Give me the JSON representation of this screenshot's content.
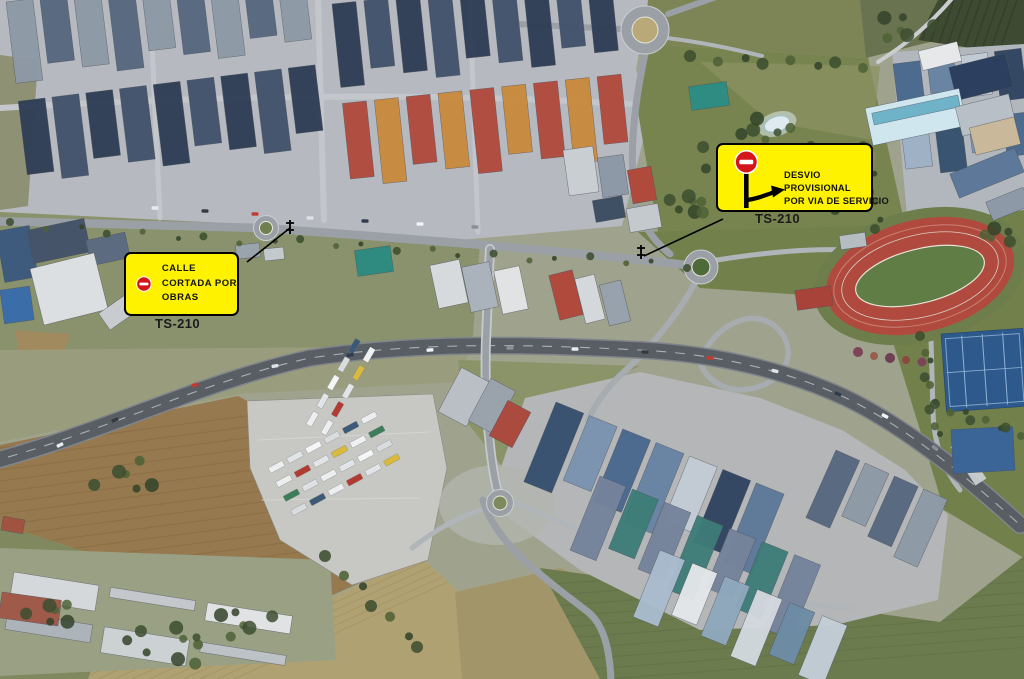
{
  "image": {
    "kind": "aerial-satellite-photo",
    "subject": "Industrial estate crossed by road TS-210 with roundabouts, highway, truck parking, athletics track and tennis courts"
  },
  "road_labels": [
    {
      "id": "ts210-west",
      "text": "TS-210"
    },
    {
      "id": "ts210-east",
      "text": "TS-210"
    }
  ],
  "annotations": {
    "colors": {
      "callout_background": "#FEF200",
      "callout_border": "#000000",
      "no_entry_red": "#D2161B",
      "no_entry_bar": "#FFFFFF",
      "leader_line": "#000000",
      "label_text": "#1B1B1B"
    },
    "closure_callout": {
      "icon": "no-entry-icon",
      "lines": [
        "CALLE",
        "CORTADA POR",
        "OBRAS"
      ]
    },
    "detour_callout": {
      "icon": "no-entry-signpost-icon",
      "arrow_icon": "detour-arrow-icon",
      "lines": [
        "DESVIO",
        "PROVISIONAL",
        "POR VIA DE SERVICIO"
      ]
    }
  }
}
